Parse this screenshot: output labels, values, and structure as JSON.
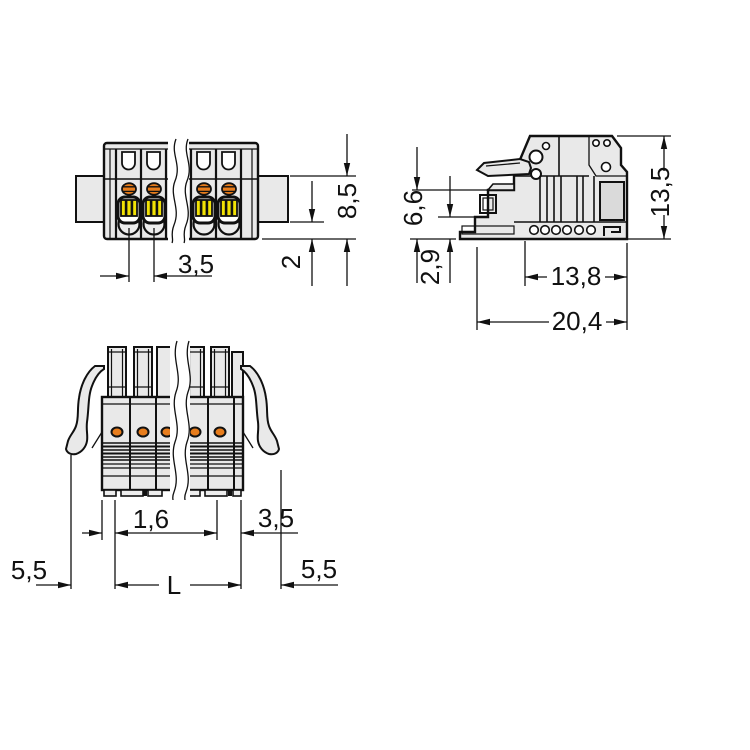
{
  "drawing_labels": {
    "front_view": {
      "pitch": "3,5",
      "total_height": "8,5",
      "strip_height": "2"
    },
    "side_view": {
      "front_height": "6,6",
      "foot_height": "2,9",
      "housing_depth": "13,8",
      "total_depth": "20,4",
      "total_height": "13,5"
    },
    "bottom_view": {
      "edge_to_pin": "1,6",
      "pin_to_edge": "3,5",
      "left_lever_offset": "5,5",
      "length": "L",
      "right_lever_offset": "5,5"
    }
  },
  "colors": {
    "outline": "#111111",
    "body": "#e9e9e9",
    "panel": "#dadada",
    "orange": "#e87d1c",
    "yellow": "#f2e205"
  }
}
